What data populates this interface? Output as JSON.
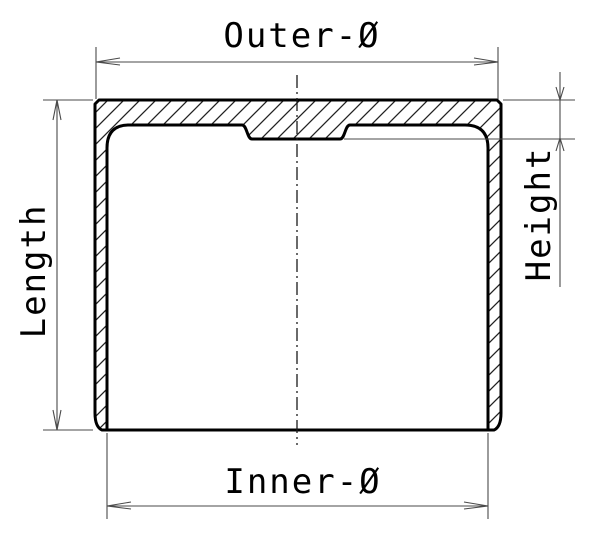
{
  "labels": {
    "outer_diameter": "Outer-Ø",
    "inner_diameter": "Inner-Ø",
    "length": "Length",
    "height": "Height"
  },
  "colors": {
    "background": "#ffffff",
    "outline": "#000000",
    "hatch": "#222222",
    "centerline": "#1a1a1a",
    "dimension": "#4a4a4a",
    "text": "#000000"
  }
}
